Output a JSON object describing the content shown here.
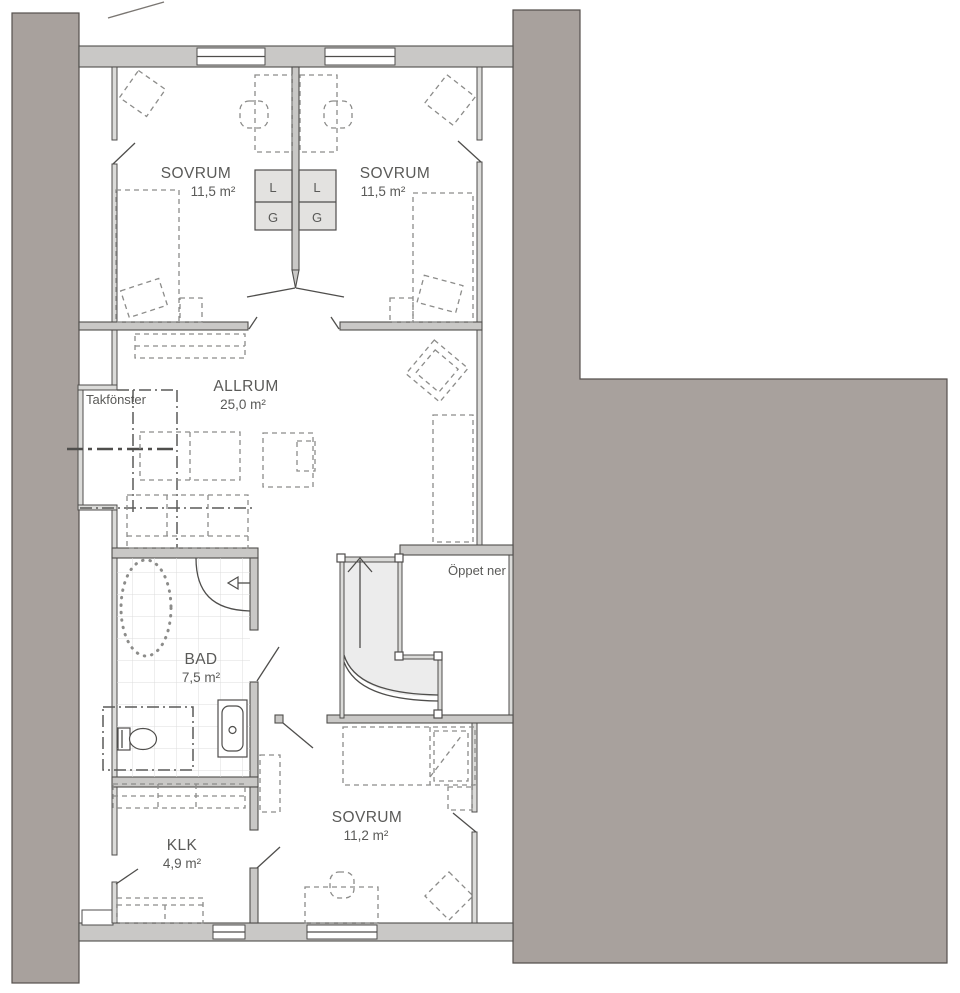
{
  "plan": {
    "title": "Floor plan – upper level",
    "rooms": [
      {
        "id": "sovrum-left",
        "name": "SOVRUM",
        "area": "11,5 m²"
      },
      {
        "id": "sovrum-right",
        "name": "SOVRUM",
        "area": "11,5 m²"
      },
      {
        "id": "allrum",
        "name": "ALLRUM",
        "area": "25,0 m²"
      },
      {
        "id": "bad",
        "name": "BAD",
        "area": "7,5 m²"
      },
      {
        "id": "klk",
        "name": "KLK",
        "area": "4,9 m²"
      },
      {
        "id": "sovrum-bottom",
        "name": "SOVRUM",
        "area": "11,2 m²"
      }
    ],
    "annotations": {
      "skylight": "Takfönster",
      "open_below": "Öppet ner"
    },
    "closets": {
      "left": {
        "top": "L",
        "bottom": "G"
      },
      "right": {
        "top": "L",
        "bottom": "G"
      }
    },
    "colors": {
      "roof": "#a8a19d",
      "wall": "#c9c8c6",
      "line": "#4f4e4c",
      "stair_fill": "#ececec",
      "closet_fill": "#e3e2e0",
      "text": "#5a5a58"
    }
  }
}
